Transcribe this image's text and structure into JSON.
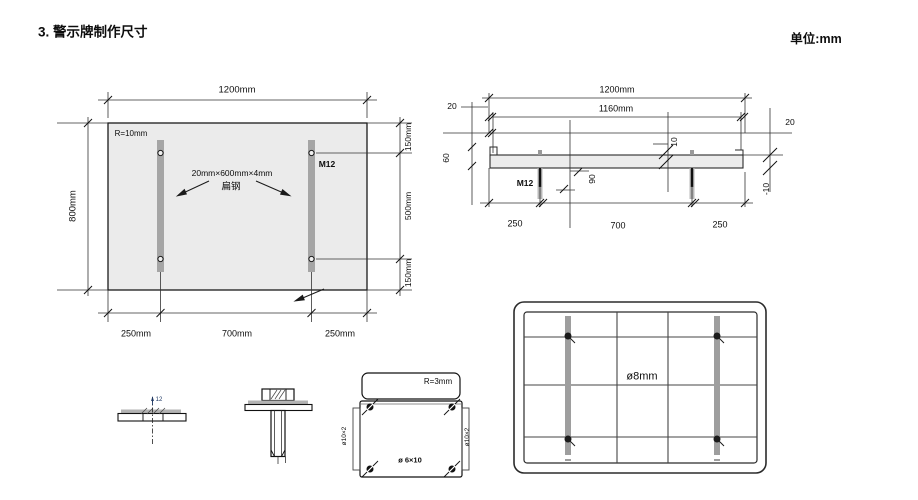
{
  "page": {
    "title": "3. 警示牌制作尺寸",
    "units": "单位:mm"
  },
  "colors": {
    "panel_fill": "#ebebeb",
    "steel_bar_gray": "#a5a5a5",
    "line_color": "#1a1a1a"
  },
  "front_view": {
    "dim_width": "1200mm",
    "dim_height": "800mm",
    "corner_radius": "R=10mm",
    "bolt_label": "M12",
    "steel_spec": "20mm×600mm×4mm",
    "steel_name": "扁钢",
    "dim_right_top": "150mm",
    "dim_right_mid": "500mm",
    "dim_right_bottom": "150mm",
    "dim_bottom_left": "250mm",
    "dim_bottom_mid": "700mm",
    "dim_bottom_right": "250mm"
  },
  "top_view": {
    "dim_width": "1200mm",
    "dim_inner_width": "1160mm",
    "dim_left_offset": "20",
    "dim_right_offset": "20",
    "dim_depth": "60",
    "dim_lip": "10",
    "bolt_label": "M12",
    "dim_bolt_length": "90",
    "dim_right_drop": "-10",
    "dim_bottom_left": "250",
    "dim_bottom_mid": "700",
    "dim_bottom_right": "250"
  },
  "details": {
    "plate_thickness": "12",
    "bracket_radius": "R=3mm",
    "hole_left": "ø10×2",
    "hole_right": "ø10×2",
    "hole_bottom": "ø 6×10"
  },
  "back_view": {
    "hole_diameter": "ø8mm"
  }
}
